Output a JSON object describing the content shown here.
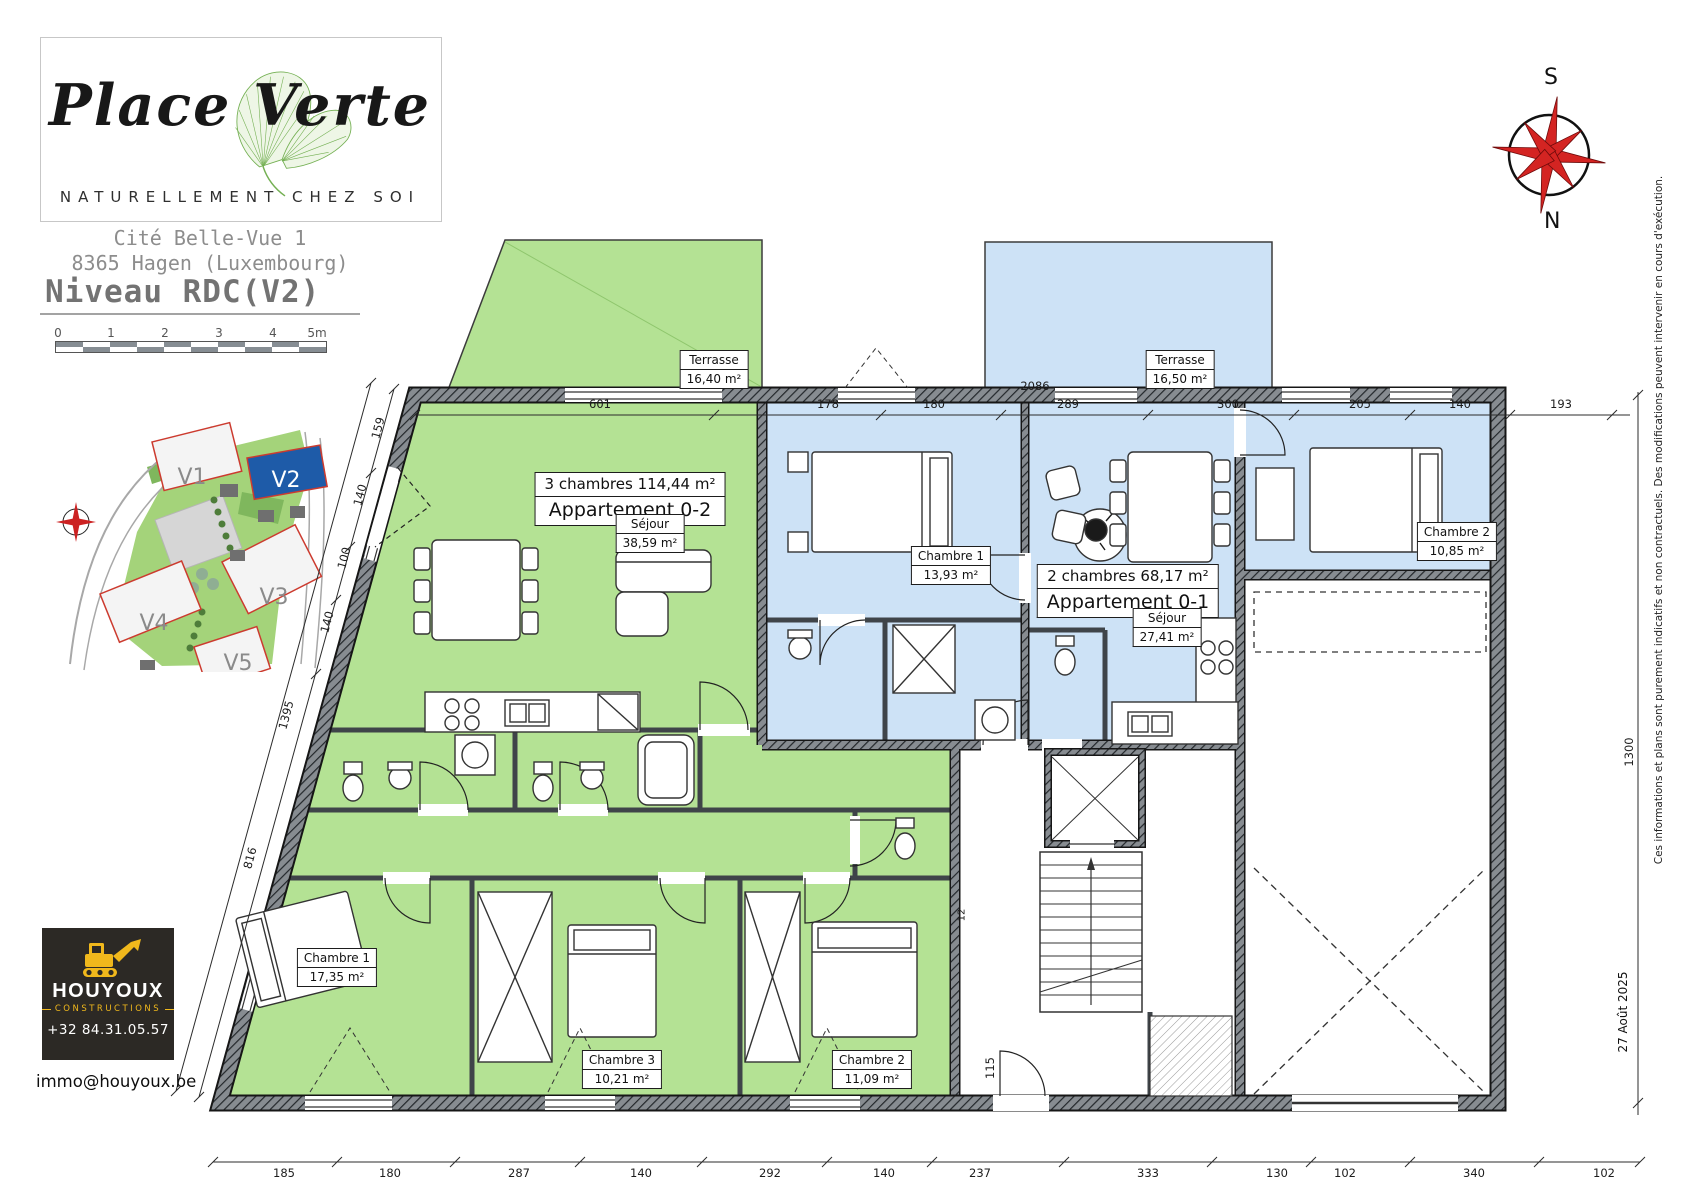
{
  "branding": {
    "logo_title": "Place Verte",
    "logo_subtitle": "NATURELLEMENT CHEZ SOI"
  },
  "header": {
    "project": "Cité Belle-Vue 1",
    "address": "8365 Hagen (Luxembourg)",
    "level": "Niveau RDC(V2)"
  },
  "scalebar": {
    "labels": [
      "0",
      "1",
      "2",
      "3",
      "4",
      "5m"
    ]
  },
  "site_plan": {
    "lots": [
      "V1",
      "V2",
      "V3",
      "V4",
      "V5"
    ],
    "highlighted_lot": "V2",
    "highlight_color": "#1e5ba8"
  },
  "compass": {
    "top": "S",
    "bottom": "N"
  },
  "apartments": [
    {
      "name": "Appartement 0-2",
      "summary": "3 chambres  114,44 m²",
      "fill": "#b4e294",
      "terrace": {
        "name": "Terrasse",
        "area": "16,40 m²"
      },
      "rooms": [
        {
          "name": "Séjour",
          "area": "38,59 m²"
        },
        {
          "name": "Chambre 1",
          "area": "17,35 m²"
        },
        {
          "name": "Chambre 3",
          "area": "10,21 m²"
        },
        {
          "name": "Chambre 2",
          "area": "11,09 m²"
        }
      ]
    },
    {
      "name": "Appartement 0-1",
      "summary": "2 chambres  68,17 m²",
      "fill": "#cde2f6",
      "terrace": {
        "name": "Terrasse",
        "area": "16,50 m²"
      },
      "rooms": [
        {
          "name": "Chambre 1",
          "area": "13,93 m²"
        },
        {
          "name": "Séjour",
          "area": "27,41 m²"
        },
        {
          "name": "Chambre 2",
          "area": "10,85 m²"
        }
      ]
    }
  ],
  "dims": {
    "overall_top": "2086",
    "top": [
      "601",
      "178",
      "180",
      "289",
      "300",
      "205",
      "140",
      "193"
    ],
    "bottom": [
      "185",
      "180",
      "287",
      "140",
      "292",
      "140",
      "237",
      "333",
      "130",
      "102",
      "340",
      "102"
    ],
    "left": [
      "159",
      "140",
      "100",
      "140",
      "1395",
      "816"
    ],
    "right": [
      "1300"
    ],
    "entry": "115",
    "stair": "12"
  },
  "footer": {
    "company": "HOUYOUX",
    "company_sub": "CONSTRUCTIONS",
    "phone": "+32 84.31.05.57",
    "email": "immo@houyoux.be",
    "accent": "#f0b81c"
  },
  "notes": {
    "disclaimer": "Ces informations et plans sont purement indicatifs et non contractuels.  Des modifications peuvent intervenir en cours d'exécution.",
    "date": "27 Août 2025"
  }
}
